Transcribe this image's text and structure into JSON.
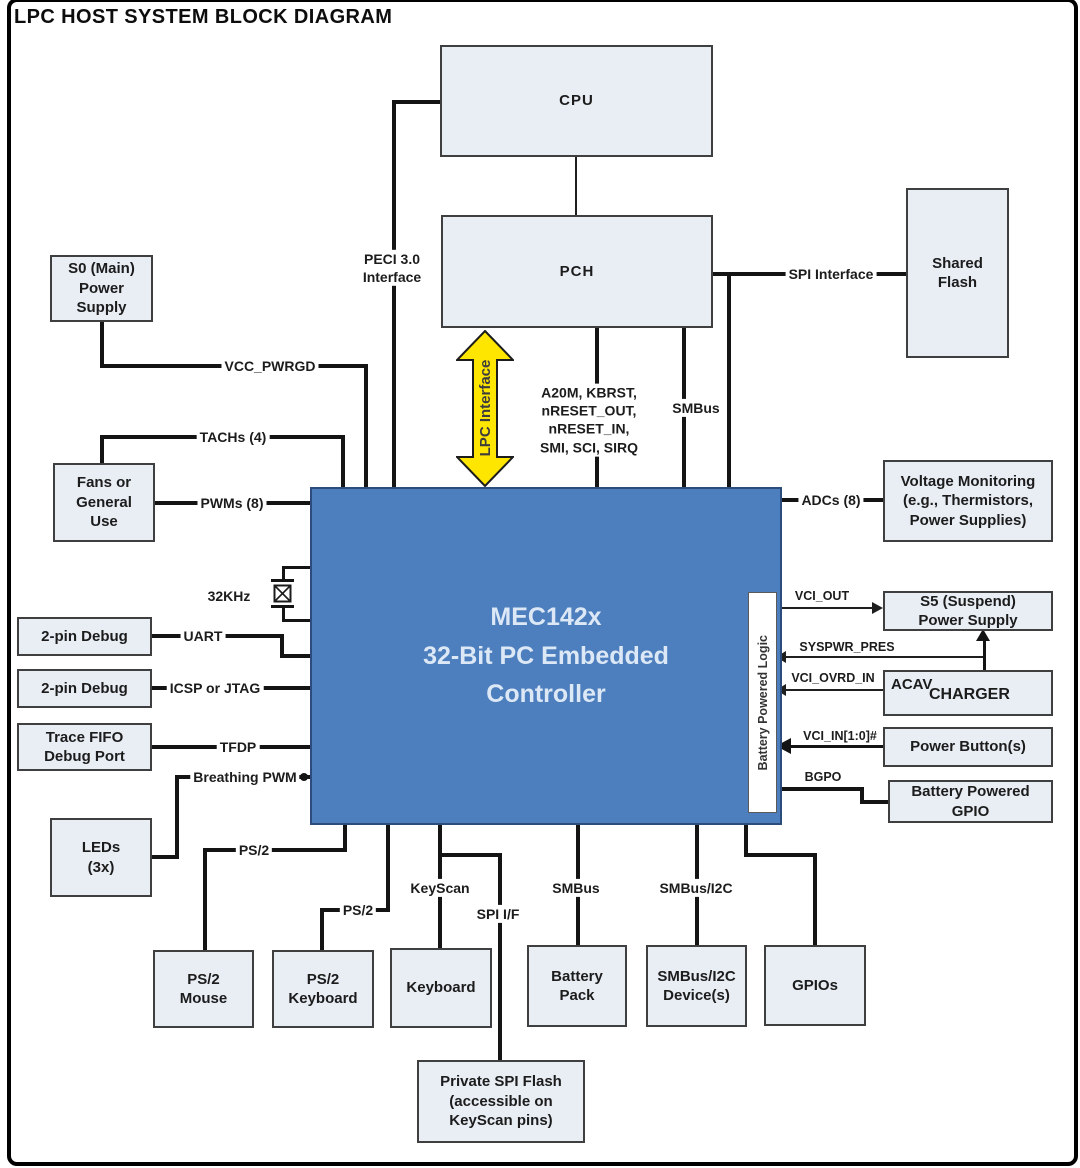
{
  "title": "LPC HOST SYSTEM BLOCK DIAGRAM",
  "controller": {
    "label": "MEC142x\n32-Bit PC Embedded\nController",
    "strip_label": "Battery Powered Logic"
  },
  "boxes": {
    "cpu": "CPU",
    "pch": "PCH",
    "shared_flash": "Shared\nFlash",
    "s0_power": "S0 (Main)\nPower\nSupply",
    "fans": "Fans or\nGeneral\nUse",
    "debug_uart": "2-pin Debug",
    "debug_icsp": "2-pin Debug",
    "trace_fifo": "Trace FIFO\nDebug Port",
    "leds": "LEDs\n(3x)",
    "ps2_mouse": "PS/2\nMouse",
    "ps2_keyboard": "PS/2\nKeyboard",
    "keyboard": "Keyboard",
    "battery_pack": "Battery\nPack",
    "smbus_devices": "SMBus/I2C\nDevice(s)",
    "gpios": "GPIOs",
    "private_flash": "Private SPI Flash\n(accessible on\nKeyScan pins)",
    "voltage_monitoring": "Voltage Monitoring\n(e.g., Thermistors,\nPower Supplies)",
    "s5_power": "S5 (Suspend)\nPower Supply",
    "charger_prefix": "ACAV",
    "charger": "CHARGER",
    "power_buttons": "Power Button(s)",
    "battery_gpio": "Battery Powered\nGPIO"
  },
  "signals": {
    "peci": "PECI 3.0\nInterface",
    "lpc": "LPC Interface",
    "spi_interface": "SPI Interface",
    "host_signals": "A20M, KBRST,\nnRESET_OUT,\nnRESET_IN,\nSMI, SCI, SIRQ",
    "smbus_pch": "SMBus",
    "vcc_pwrgd": "VCC_PWRGD",
    "tachs": "TACHs (4)",
    "pwms": "PWMs (8)",
    "clock_32khz": "32KHz",
    "uart": "UART",
    "icsp_jtag": "ICSP or JTAG",
    "tfdp": "TFDP",
    "breathing_pwm": "Breathing PWM",
    "ps2_mouse": "PS/2",
    "ps2_keyboard": "PS/2",
    "keyscan": "KeyScan",
    "spi_if": "SPI I/F",
    "smbus_battery": "SMBus",
    "smbus_i2c": "SMBus/I2C",
    "adcs": "ADCs (8)",
    "vci_out": "VCI_OUT",
    "syspwr_pres": "SYSPWR_PRES",
    "vci_ovrd_in": "VCI_OVRD_IN",
    "vci_in": "VCI_IN[1:0]#",
    "bgpo": "BGPO"
  },
  "colors": {
    "controller_fill": "#4d7ebd",
    "controller_text": "#dce8f5",
    "box_fill": "#e9eef5",
    "box_border": "#3f3f3f",
    "line": "#141414",
    "lpc_arrow_fill": "#ffe600"
  }
}
